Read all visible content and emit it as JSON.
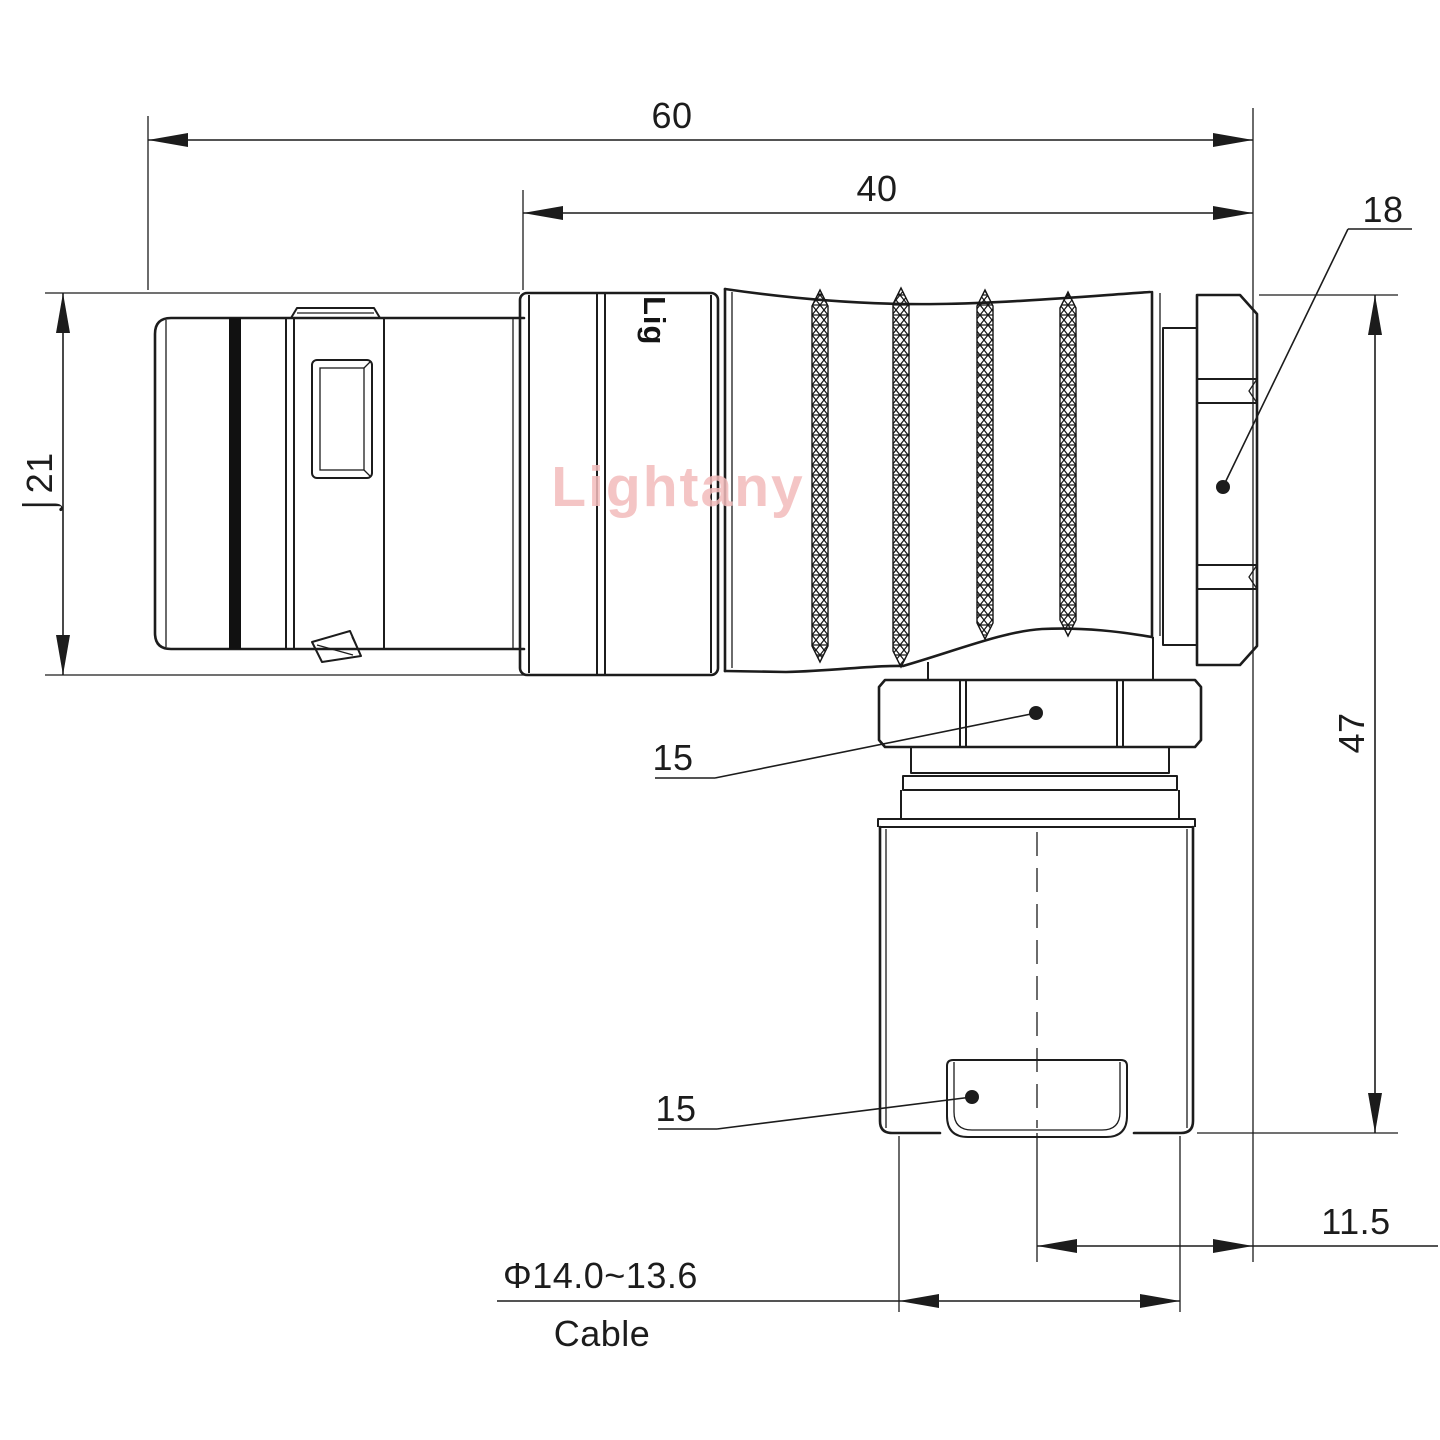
{
  "drawing": {
    "type": "technical-dimension-drawing",
    "subject": "right-angle circular push-pull connector, side elevation",
    "watermark": "Lightany",
    "shell_print": "Lig",
    "colors": {
      "line": "#1c1c1c",
      "watermark": "#f3bcbc",
      "background": "#ffffff"
    },
    "dimensions": {
      "overall_length": "60",
      "rear_section_length": "40",
      "backnut_width": "18",
      "front_diameter": "⌡21",
      "overall_height": "47",
      "coupling_nut_width": "15",
      "cable_clamp_width": "15",
      "cable_axis_offset": "11.5",
      "cable_diameter_range": "Φ14.0~13.6",
      "cable_label": "Cable"
    }
  }
}
